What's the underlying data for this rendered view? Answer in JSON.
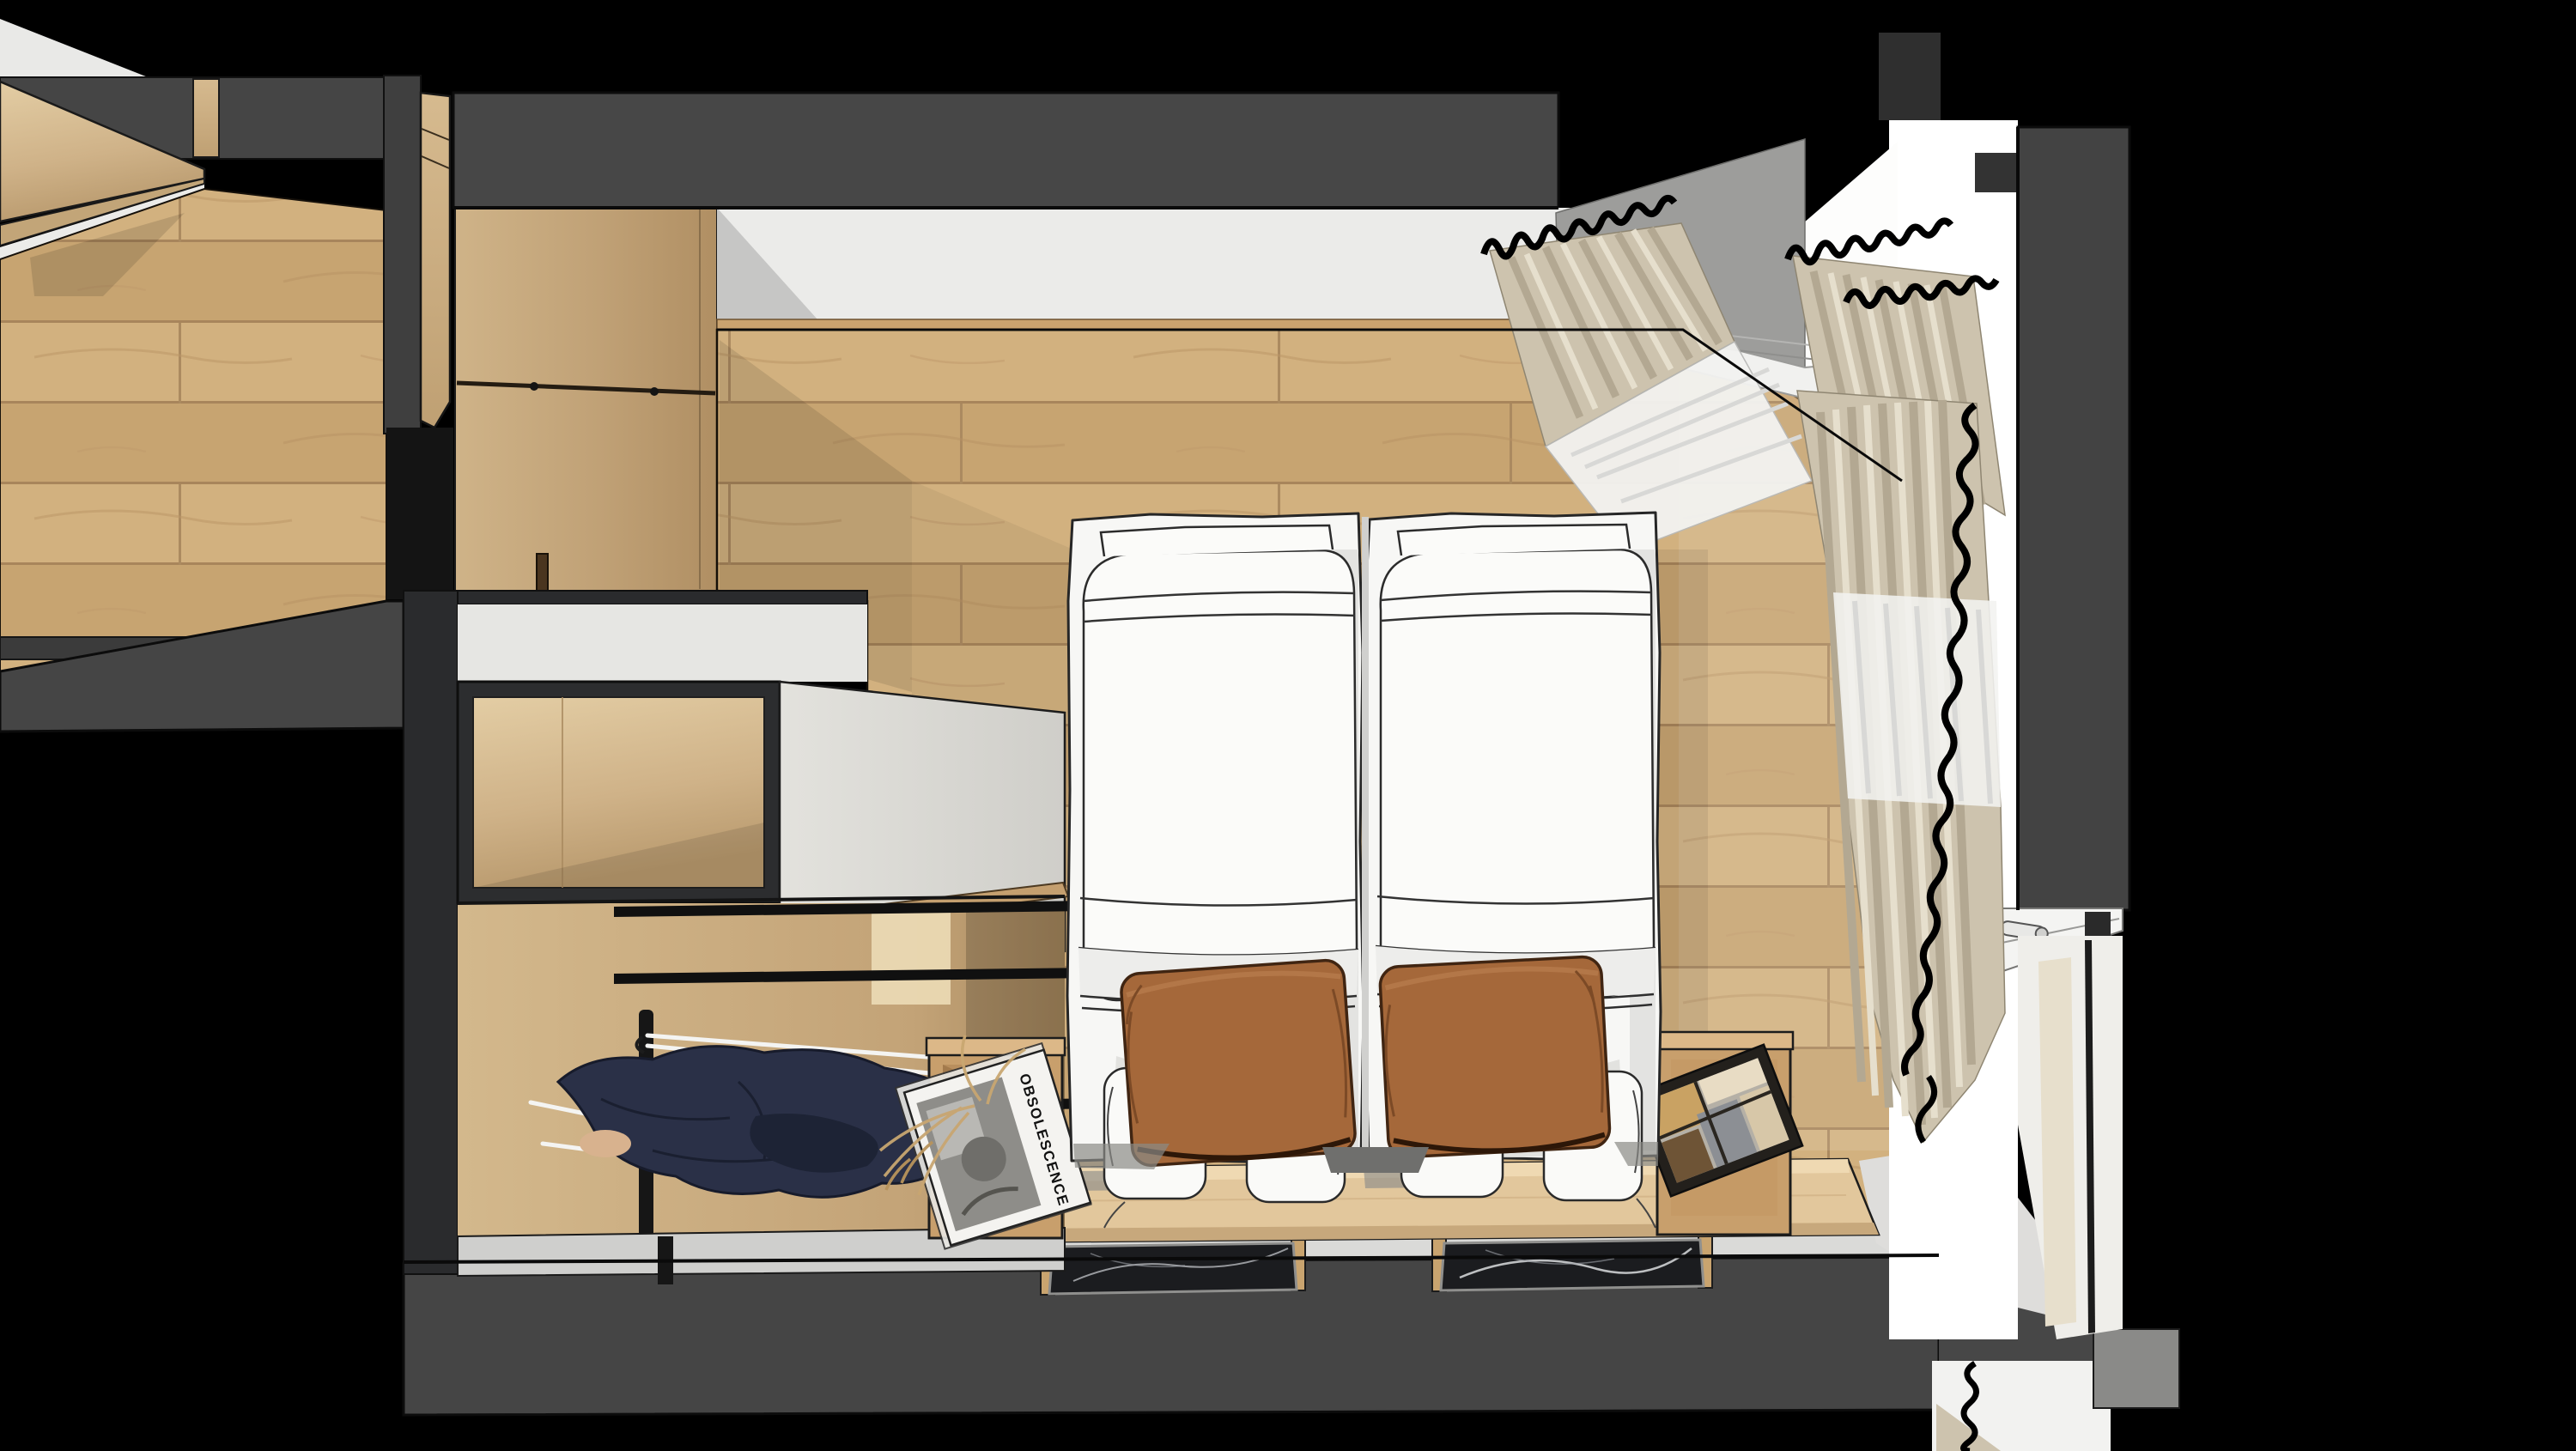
{
  "scene": {
    "type": "3d-architectural-render",
    "view": "top-down section (bird's eye) of a bedroom",
    "render_style": "sketchup-like line render with textures",
    "background_color": "#000000",
    "palette": {
      "cut_wall_gray": "#474747",
      "wall_white": "#ebebe9",
      "ceiling_gray": "#9d9d9b",
      "floor_wood": "#cdaa79",
      "panel_wood": "#c9ad82",
      "headboard_wood": "#e2c79c",
      "bed_white": "#f7f7f5",
      "pillow_brown": "#a5683a",
      "curtain_beige": "#cdc3ae",
      "sheer_white": "#f2f2f0",
      "marble_black": "#1b1c1f",
      "clothes_navy": "#2a3047",
      "cabinet_frame_dark": "#2c2d2f"
    },
    "objects": [
      "twin bed left with white duvet and brown pillow",
      "twin bed right with white duvet and brown pillow",
      "wooden headboard ledge",
      "left nightstand box with magazine and dried grass",
      "right nightstand box with photo book",
      "black marble wall shelves",
      "open wardrobe with clothes rails, hangers and navy garments",
      "upper cabinet with white side gable",
      "entrance door and wood panelled wall",
      "window wall with beige pleated curtains and white sheers",
      "window frame with handle",
      "adjacent hallway with wood floor and tall cabinet"
    ],
    "nightstand_left": {
      "magazine_title": "OBSOLESCENCE"
    }
  }
}
